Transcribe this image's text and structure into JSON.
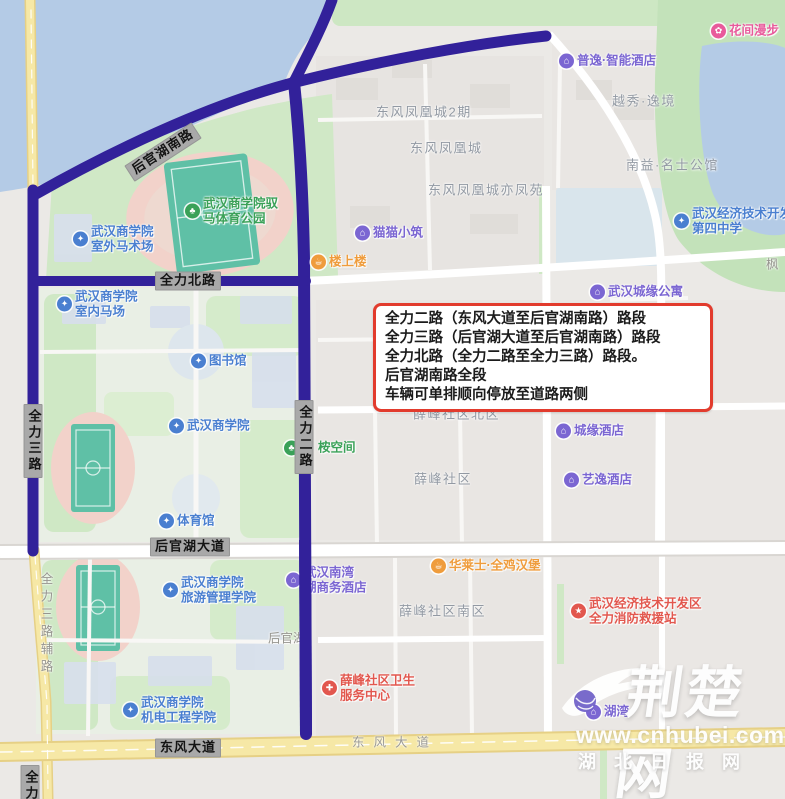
{
  "annotation": {
    "lines": [
      "全力二路（东风大道至后官湖南路）路段",
      "全力三路（后官湖大道至后官湖南路）路段",
      "全力北路（全力二路至全力三路）路段。",
      "后官湖南路全段",
      "车辆可单排顺向停放至道路两侧"
    ]
  },
  "watermark": {
    "brand": "荆楚网",
    "url": "www.cnhubei.com",
    "sub": "湖北日报网"
  },
  "colors": {
    "school": "#4a7fd0",
    "hotel": "#7b66d2",
    "park": "#3aa158",
    "food": "#ef9c3c",
    "health": "#e2574e",
    "fire": "#e2574e",
    "flower": "#e85a9b",
    "road_highlight": "#32219a",
    "road_yellow": "#f6e8a6",
    "water": "#b4cbe6",
    "green": "#cde7c3",
    "badge_bg": "#a9a9a9",
    "gray_label": "#9299a3",
    "box_border": "#e23b2d"
  },
  "glyphs": {
    "school": "✦",
    "hotel": "⌂",
    "park": "♣",
    "food": "☕",
    "health": "✚",
    "fire": "★",
    "flower": "✿"
  },
  "map": {
    "badges": [
      {
        "id": "houguanhu-south-rd",
        "text": "后官湖南路",
        "x": 163,
        "y": 152,
        "rot": -33
      },
      {
        "id": "quanli-north-rd",
        "text": "全力北路",
        "x": 188,
        "y": 281
      },
      {
        "id": "quanli-3rd-rd",
        "text": "全力三路",
        "x": 33,
        "y": 441,
        "vertical": true
      },
      {
        "id": "quanli-2nd-rd",
        "text": "全力二路",
        "x": 304,
        "y": 437,
        "vertical": true
      },
      {
        "id": "houguanhu-ave",
        "text": "后官湖大道",
        "x": 190,
        "y": 547
      },
      {
        "id": "dongfeng-ave",
        "text": "东风大道",
        "x": 188,
        "y": 748
      },
      {
        "id": "quanli-clipped",
        "text": "全力",
        "x": 30,
        "y": 786,
        "vertical": true
      }
    ],
    "gray_texts": [
      {
        "id": "dongfeng-ave-text",
        "text": "东风大道",
        "x": 352,
        "y": 741,
        "spaced": true
      },
      {
        "id": "quanli-3rd-side-rd",
        "text": "全力三路辅路",
        "x": 46,
        "y": 572,
        "vertical": true
      },
      {
        "id": "feng-partial",
        "text": "枫",
        "x": 766,
        "y": 263
      },
      {
        "id": "houguanhu-partial",
        "text": "后官湖",
        "x": 268,
        "y": 637,
        "under": true
      }
    ],
    "area_labels": [
      {
        "id": "yuexiu-yijing",
        "text": "越秀·逸境",
        "x": 612,
        "y": 100
      },
      {
        "id": "nanyi-mingshi-mansion",
        "text": "南益·名士公馆",
        "x": 626,
        "y": 164
      },
      {
        "id": "dongfeng-phoenix-city-2",
        "text": "东风凤凰城2期",
        "x": 376,
        "y": 111
      },
      {
        "id": "dongfeng-phoenix-city",
        "text": "东风凤凰城",
        "x": 410,
        "y": 147
      },
      {
        "id": "dongfeng-phoenix-yifengyuan",
        "text": "东风凤凰城亦凤苑",
        "x": 428,
        "y": 189
      },
      {
        "id": "xuefeng-community-north",
        "text": "薛峰社区北区",
        "x": 413,
        "y": 413
      },
      {
        "id": "xuefeng-community",
        "text": "薛峰社区",
        "x": 414,
        "y": 478
      },
      {
        "id": "xuefeng-community-south",
        "text": "薛峰社区南区",
        "x": 399,
        "y": 610
      }
    ],
    "pois": [
      {
        "id": "huajian-manbu",
        "kind": "flower",
        "x": 711,
        "y": 31,
        "lines": [
          "花间漫步"
        ]
      },
      {
        "id": "puyi-smart-hotel",
        "kind": "hotel",
        "x": 559,
        "y": 61,
        "lines": [
          "普逸·智能酒店"
        ]
      },
      {
        "id": "maomao-xiaozhu",
        "kind": "hotel",
        "x": 355,
        "y": 233,
        "lines": [
          "猫猫小筑"
        ]
      },
      {
        "id": "loushanglou",
        "kind": "food",
        "x": 311,
        "y": 262,
        "lines": [
          "楼上楼"
        ]
      },
      {
        "id": "chengyuan-apartment",
        "kind": "hotel",
        "x": 590,
        "y": 292,
        "lines": [
          "武汉城缘公寓"
        ]
      },
      {
        "id": "wedz-no4-middle-school",
        "kind": "school",
        "x": 674,
        "y": 221,
        "lines": [
          "武汉经济技术开发区",
          "第四中学"
        ]
      },
      {
        "id": "yuma-sports-park",
        "kind": "park",
        "x": 185,
        "y": 211,
        "lines": [
          "武汉商学院驭",
          "马体育公园"
        ]
      },
      {
        "id": "outdoor-equestrian-ground",
        "kind": "school",
        "x": 73,
        "y": 239,
        "lines": [
          "武汉商学院",
          "室外马术场"
        ]
      },
      {
        "id": "indoor-equestrian-hall",
        "kind": "school",
        "x": 57,
        "y": 304,
        "lines": [
          "武汉商学院",
          "室内马场"
        ]
      },
      {
        "id": "library",
        "kind": "school",
        "x": 191,
        "y": 361,
        "lines": [
          "图书馆"
        ]
      },
      {
        "id": "wuhan-business-university",
        "kind": "school",
        "x": 169,
        "y": 426,
        "lines": [
          "武汉商学院"
        ]
      },
      {
        "id": "an-space",
        "kind": "park",
        "x": 284,
        "y": 448,
        "lines": [
          "桉空间"
        ],
        "gap": 16
      },
      {
        "id": "gymnasium",
        "kind": "school",
        "x": 159,
        "y": 521,
        "lines": [
          "体育馆"
        ]
      },
      {
        "id": "chengyuan-hotel",
        "kind": "hotel",
        "x": 556,
        "y": 431,
        "lines": [
          "城缘酒店"
        ]
      },
      {
        "id": "yiyi-hotel",
        "kind": "hotel",
        "x": 564,
        "y": 480,
        "lines": [
          "艺逸酒店"
        ]
      },
      {
        "id": "tourism-management-college",
        "kind": "school",
        "x": 163,
        "y": 590,
        "lines": [
          "武汉商学院",
          "旅游管理学院"
        ]
      },
      {
        "id": "nanwan-business-hotel",
        "kind": "hotel",
        "x": 286,
        "y": 580,
        "lines": [
          "武汉南湾",
          "湖商务酒店"
        ],
        "under": true
      },
      {
        "id": "hualaishi-burger",
        "kind": "food",
        "x": 431,
        "y": 566,
        "lines": [
          "华莱士·全鸡汉堡"
        ]
      },
      {
        "id": "xuefeng-health-center",
        "kind": "health",
        "x": 322,
        "y": 688,
        "lines": [
          "薛峰社区卫生",
          "服务中心"
        ]
      },
      {
        "id": "quanli-fire-rescue-station",
        "kind": "fire",
        "x": 571,
        "y": 611,
        "lines": [
          "武汉经济技术开发区",
          "全力消防救援站"
        ]
      },
      {
        "id": "mech-engineering-college",
        "kind": "school",
        "x": 123,
        "y": 710,
        "lines": [
          "武汉商学院",
          "机电工程学院"
        ]
      },
      {
        "id": "huwan",
        "kind": "hotel",
        "x": 586,
        "y": 712,
        "lines": [
          "湖湾"
        ]
      }
    ]
  }
}
